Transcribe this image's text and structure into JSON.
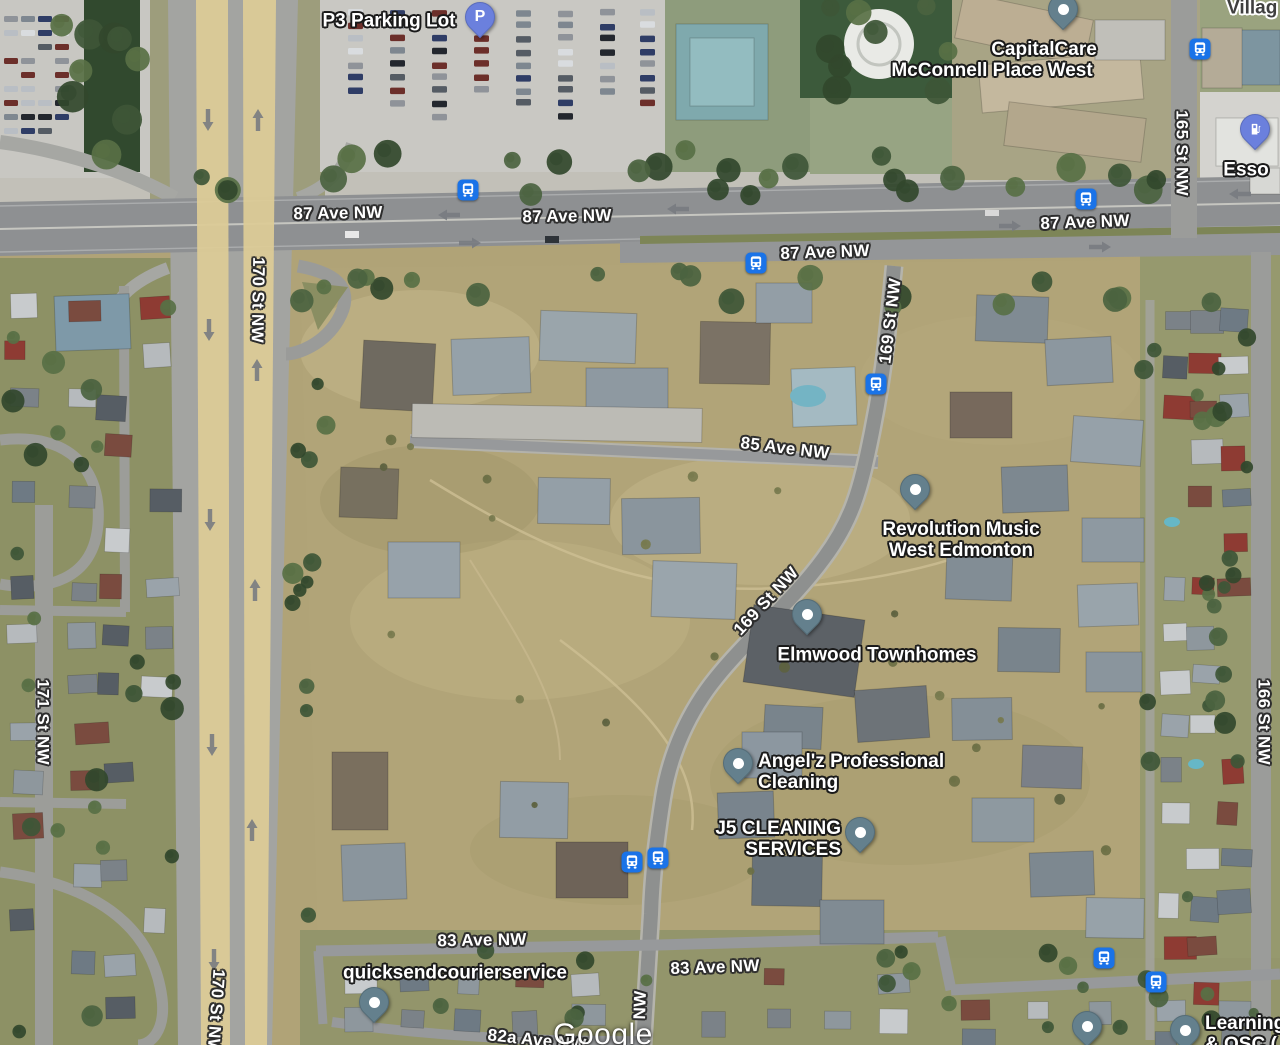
{
  "watermark": "Google",
  "colors": {
    "bus_icon": "#1a73e8",
    "poi_pin": "#64808d",
    "transport_pin": "#6b80dd",
    "road_label_text": "#ffffff",
    "major_road_fill": "#dccb97"
  },
  "road_labels": [
    {
      "text": "87 Ave NW",
      "x": 338,
      "y": 213,
      "rot": -1
    },
    {
      "text": "87 Ave NW",
      "x": 567,
      "y": 216,
      "rot": -1
    },
    {
      "text": "87 Ave NW",
      "x": 825,
      "y": 252,
      "rot": -2
    },
    {
      "text": "87 Ave NW",
      "x": 1085,
      "y": 222,
      "rot": -2
    },
    {
      "text": "85 Ave NW",
      "x": 785,
      "y": 448,
      "rot": 7
    },
    {
      "text": "83 Ave NW",
      "x": 482,
      "y": 940,
      "rot": -1
    },
    {
      "text": "83 Ave NW",
      "x": 715,
      "y": 967,
      "rot": -2
    },
    {
      "text": "82a Ave NW",
      "x": 537,
      "y": 1040,
      "rot": 6
    },
    {
      "text": "170 St NW",
      "x": 258,
      "y": 300,
      "rot": 91
    },
    {
      "text": "170 St NW",
      "x": 216,
      "y": 1012,
      "rot": 94
    },
    {
      "text": "171 St NW",
      "x": 43,
      "y": 722,
      "rot": 90
    },
    {
      "text": "169 St NW",
      "x": 890,
      "y": 321,
      "rot": -83
    },
    {
      "text": "169 St NW",
      "x": 766,
      "y": 601,
      "rot": -47
    },
    {
      "text": "NW",
      "x": 640,
      "y": 1005,
      "rot": -88
    },
    {
      "text": "165 St NW",
      "x": 1182,
      "y": 153,
      "rot": 90
    },
    {
      "text": "166 St NW",
      "x": 1264,
      "y": 722,
      "rot": 90
    }
  ],
  "place_labels": [
    {
      "id": "p3-parking-lot",
      "lines": [
        "P3 Parking Lot"
      ],
      "x": 389,
      "y": 21,
      "align": "center"
    },
    {
      "id": "capitalcare-mcconnell-place-west",
      "lines": [
        "CapitalCare",
        "McConnell Place West"
      ],
      "x": 992,
      "y": 60,
      "align": "center",
      "dx": [
        52,
        0
      ]
    },
    {
      "id": "esso",
      "lines": [
        "Esso"
      ],
      "x": 1246,
      "y": 170,
      "align": "center"
    },
    {
      "id": "village-partial",
      "lines": [
        "Villag"
      ],
      "x": 1227,
      "y": 8,
      "align": "left",
      "dark": true
    },
    {
      "id": "revolution-music-west-edmonton",
      "lines": [
        "Revolution Music",
        "West Edmonton"
      ],
      "x": 961,
      "y": 540,
      "align": "center"
    },
    {
      "id": "elmwood-townhomes",
      "lines": [
        "Elmwood Townhomes"
      ],
      "x": 877,
      "y": 655,
      "align": "center"
    },
    {
      "id": "angelz-professional-cleaning",
      "lines": [
        "Angel'z Professional",
        "Cleaning"
      ],
      "x": 758,
      "y": 772,
      "align": "left"
    },
    {
      "id": "j5-cleaning-services",
      "lines": [
        "J5 CLEANING",
        "SERVICES"
      ],
      "x": 841,
      "y": 839,
      "align": "right"
    },
    {
      "id": "quicksendcourierservice",
      "lines": [
        "quicksendcourierservice"
      ],
      "x": 455,
      "y": 973,
      "align": "center"
    },
    {
      "id": "learning-osc",
      "lines": [
        "Learning",
        "& OSC ("
      ],
      "x": 1205,
      "y": 1034,
      "align": "left"
    }
  ],
  "pins": [
    {
      "name": "p3-parking",
      "type": "parking",
      "glyph": "P",
      "x": 480,
      "y": 17
    },
    {
      "name": "capitalcare",
      "type": "poi",
      "x": 1063,
      "y": 9
    },
    {
      "name": "esso-gas-station",
      "type": "gas",
      "x": 1255,
      "y": 129
    },
    {
      "name": "revolution-music",
      "type": "poi",
      "x": 915,
      "y": 489
    },
    {
      "name": "elmwood-townhomes",
      "type": "poi",
      "x": 807,
      "y": 614
    },
    {
      "name": "angelz-cleaning",
      "type": "poi",
      "x": 738,
      "y": 763
    },
    {
      "name": "j5-cleaning",
      "type": "poi",
      "x": 860,
      "y": 832
    },
    {
      "name": "quicksendcourierservice",
      "type": "poi",
      "x": 374,
      "y": 1002
    },
    {
      "name": "unlabeled-place",
      "type": "poi",
      "x": 1087,
      "y": 1026
    },
    {
      "name": "learning-osc",
      "type": "poi",
      "x": 1185,
      "y": 1030
    }
  ],
  "bus_stops": [
    {
      "x": 468,
      "y": 190
    },
    {
      "x": 756,
      "y": 263
    },
    {
      "x": 876,
      "y": 384
    },
    {
      "x": 1086,
      "y": 199
    },
    {
      "x": 1200,
      "y": 49
    },
    {
      "x": 632,
      "y": 862
    },
    {
      "x": 658,
      "y": 858
    },
    {
      "x": 1104,
      "y": 958
    },
    {
      "x": 1156,
      "y": 982
    }
  ]
}
